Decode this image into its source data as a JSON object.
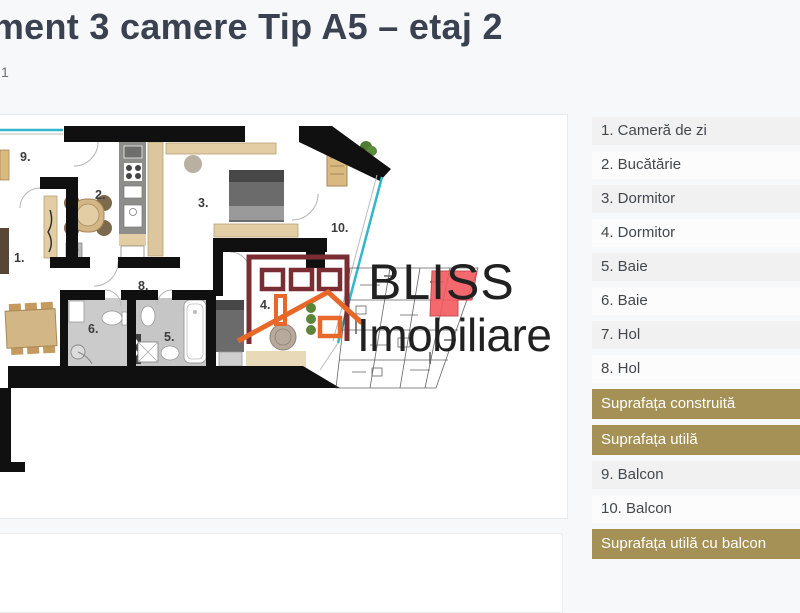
{
  "header": {
    "title": "Apartament 3 camere Tip A5 – etaj 2",
    "subtitle_fragment": "1"
  },
  "floorplan": {
    "watermark": {
      "brand_line1": "BLISS",
      "brand_line2": "Imobiliare"
    },
    "room_labels": [
      "9.",
      "2.",
      "3.",
      "1.",
      "8.",
      "10.",
      "4.",
      "6.",
      "5."
    ],
    "colors": {
      "walls": "#101010",
      "window_teal": "#35b6cd",
      "furniture_beige": "#e2cda4",
      "bath_floor_gray": "#cbcbcb",
      "logo_maroon": "#7a2e34",
      "logo_orange": "#e8682a",
      "unit_marker_red": "#f2595f"
    }
  },
  "legend": {
    "accent_color": "#a59155",
    "row_shade_color": "#f1f1f2",
    "items": [
      {
        "label": "1. Cameră de zi",
        "variant": "shaded"
      },
      {
        "label": "2. Bucătărie",
        "variant": "plain"
      },
      {
        "label": "3. Dormitor",
        "variant": "shaded"
      },
      {
        "label": "4. Dormitor",
        "variant": "plain"
      },
      {
        "label": "5. Baie",
        "variant": "shaded"
      },
      {
        "label": "6. Baie",
        "variant": "plain"
      },
      {
        "label": "7. Hol",
        "variant": "shaded"
      },
      {
        "label": "8. Hol",
        "variant": "plain"
      },
      {
        "label": "Suprafața construită",
        "variant": "highlight"
      },
      {
        "label": "Suprafața utilă",
        "variant": "highlight"
      },
      {
        "label": "9. Balcon",
        "variant": "shaded"
      },
      {
        "label": "10. Balcon",
        "variant": "plain"
      },
      {
        "label": "Suprafața utilă cu balcon",
        "variant": "highlight"
      }
    ]
  }
}
